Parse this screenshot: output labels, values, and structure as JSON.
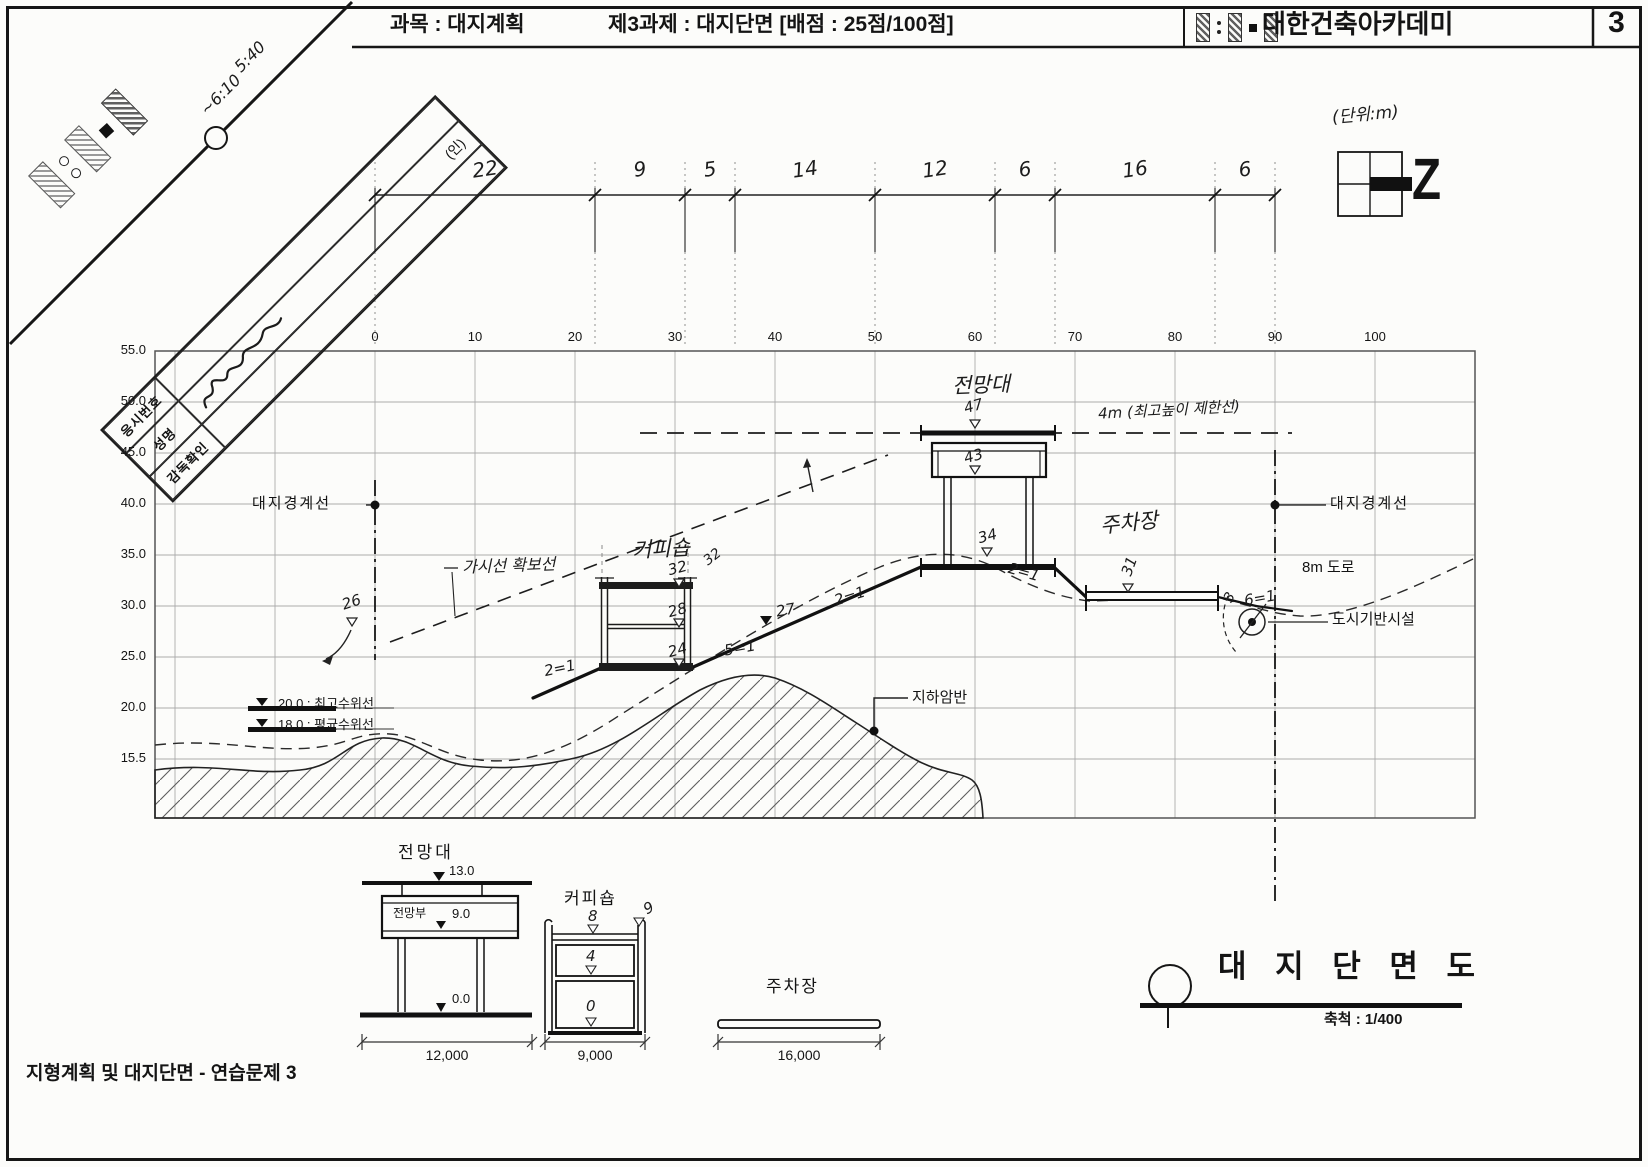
{
  "header": {
    "subject": "과목 : 대지계획",
    "task": "제3과제 : 대지단면 [배점 : 25점/100점]",
    "academy": "대한건축아카데미",
    "page": "3"
  },
  "form": {
    "field1": "응시번호",
    "field2": "성명",
    "field3": "감독확인",
    "seal": "(인)",
    "time1": "5:40",
    "time2": "~6:10"
  },
  "notes": {
    "unit": "(단위:m)",
    "north": "Z"
  },
  "axes": {
    "y": [
      "55.0",
      "50.0",
      "45.0",
      "40.0",
      "35.0",
      "30.0",
      "25.0",
      "20.0",
      "15.5"
    ],
    "x": [
      "0",
      "10",
      "20",
      "30",
      "40",
      "50",
      "60",
      "70",
      "80",
      "90",
      "100"
    ]
  },
  "dims": [
    "22",
    "9",
    "5",
    "14",
    "12",
    "6",
    "16",
    "6"
  ],
  "labels": {
    "boundary_left": "대지경계선",
    "boundary_right": "대지경계선",
    "sight": "가시선 확보선",
    "limit": "4m (최고높이 제한선)",
    "observatory": "전망대",
    "coffee": "커피숍",
    "parking": "주차장",
    "road": "8m 도로",
    "infra": "도시기반시설",
    "rock": "지하암반",
    "water_max": "20.0 : 최고수위선",
    "water_avg": "18.0 : 평균수위선"
  },
  "ann": {
    "obs_top": "47",
    "obs_deck": "43",
    "obs_base": "34",
    "cof_top": "32",
    "cof_parapet": "32",
    "cof_mid": "28",
    "cof_base": "24",
    "bench": "27",
    "bound_ground": "26",
    "park_level": "31",
    "slope_a": "2=1",
    "slope_b": "2=1",
    "slope_c": "2=1",
    "slope_bench": "5=1",
    "slope_road": "6=1",
    "road_x": "3"
  },
  "details": {
    "obs": {
      "title": "전망대",
      "top": "13.0",
      "deck": "전망부",
      "mid": "9.0",
      "base": "0.0",
      "width": "12,000"
    },
    "cof": {
      "title": "커피숍",
      "roof": "8",
      "parapet": "9",
      "mid": "4",
      "base": "0",
      "width": "9,000"
    },
    "park": {
      "title": "주차장",
      "width": "16,000"
    }
  },
  "titleblock": {
    "title": "대 지 단 면 도",
    "scale": "축척 : 1/400"
  },
  "footer": {
    "text": "지형계획 및 대지단면 - 연습문제 3"
  }
}
